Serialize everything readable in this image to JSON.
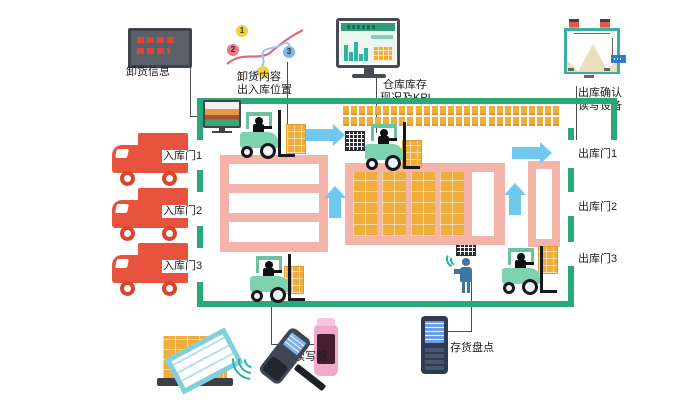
{
  "doors": {
    "inbound": [
      "入库门1",
      "入库门2",
      "入库门3"
    ],
    "outbound": [
      "出库门1",
      "出库门2",
      "出库门3"
    ]
  },
  "stations": {
    "unload_info": {
      "label": "卸货信息"
    },
    "unload_position": {
      "label_line1": "卸货内容",
      "label_line2": "出入库位置",
      "pins": [
        "1",
        "2",
        "3"
      ]
    },
    "inventory_kpi": {
      "label_line1": "仓库库存",
      "label_line2": "现况及KPI"
    },
    "outbound_confirm": {
      "label_line1": "出库确认",
      "label_line2": "读写设备"
    },
    "forklift_reader": {
      "label": "叉车读写器"
    },
    "stock_count": {
      "label": "存货盘点"
    }
  },
  "colors": {
    "wall_green": "#2ba878",
    "rack_pink": "#f5b4aa",
    "pallet_orange": "#efae3b",
    "arrow_blue": "#6fc8f0",
    "truck_red": "#e8533e",
    "forklift_green": "#7fd2af"
  }
}
